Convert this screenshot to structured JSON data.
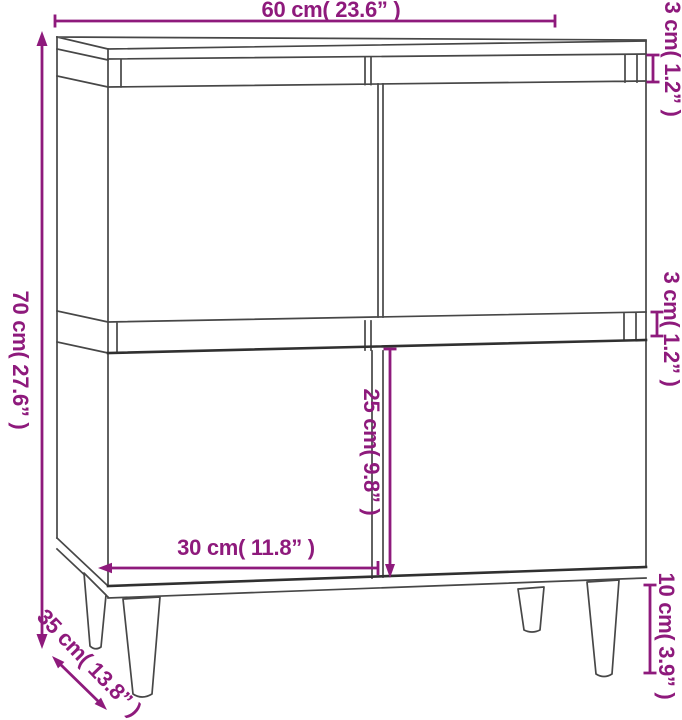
{
  "figure": {
    "alt": "Line drawing of a four-door sideboard cabinet on tapered legs, annotated with dimension arrows"
  },
  "colors": {
    "dimension": "#8e1a7c",
    "line": "#474747",
    "line_dark": "#303030",
    "background": "#ffffff"
  },
  "labels": {
    "width": "60 cm( 23.6” )",
    "top_thickness": "3 cm( 1.2” )",
    "height": "70 cm( 27.6” )",
    "shelf_thickness": "3 cm( 1.2” )",
    "door_height": "25 cm( 9.8” )",
    "door_width": "30 cm( 11.8” )",
    "depth": "35 cm( 13.8” )",
    "leg_height": "10 cm( 3.9” )"
  }
}
